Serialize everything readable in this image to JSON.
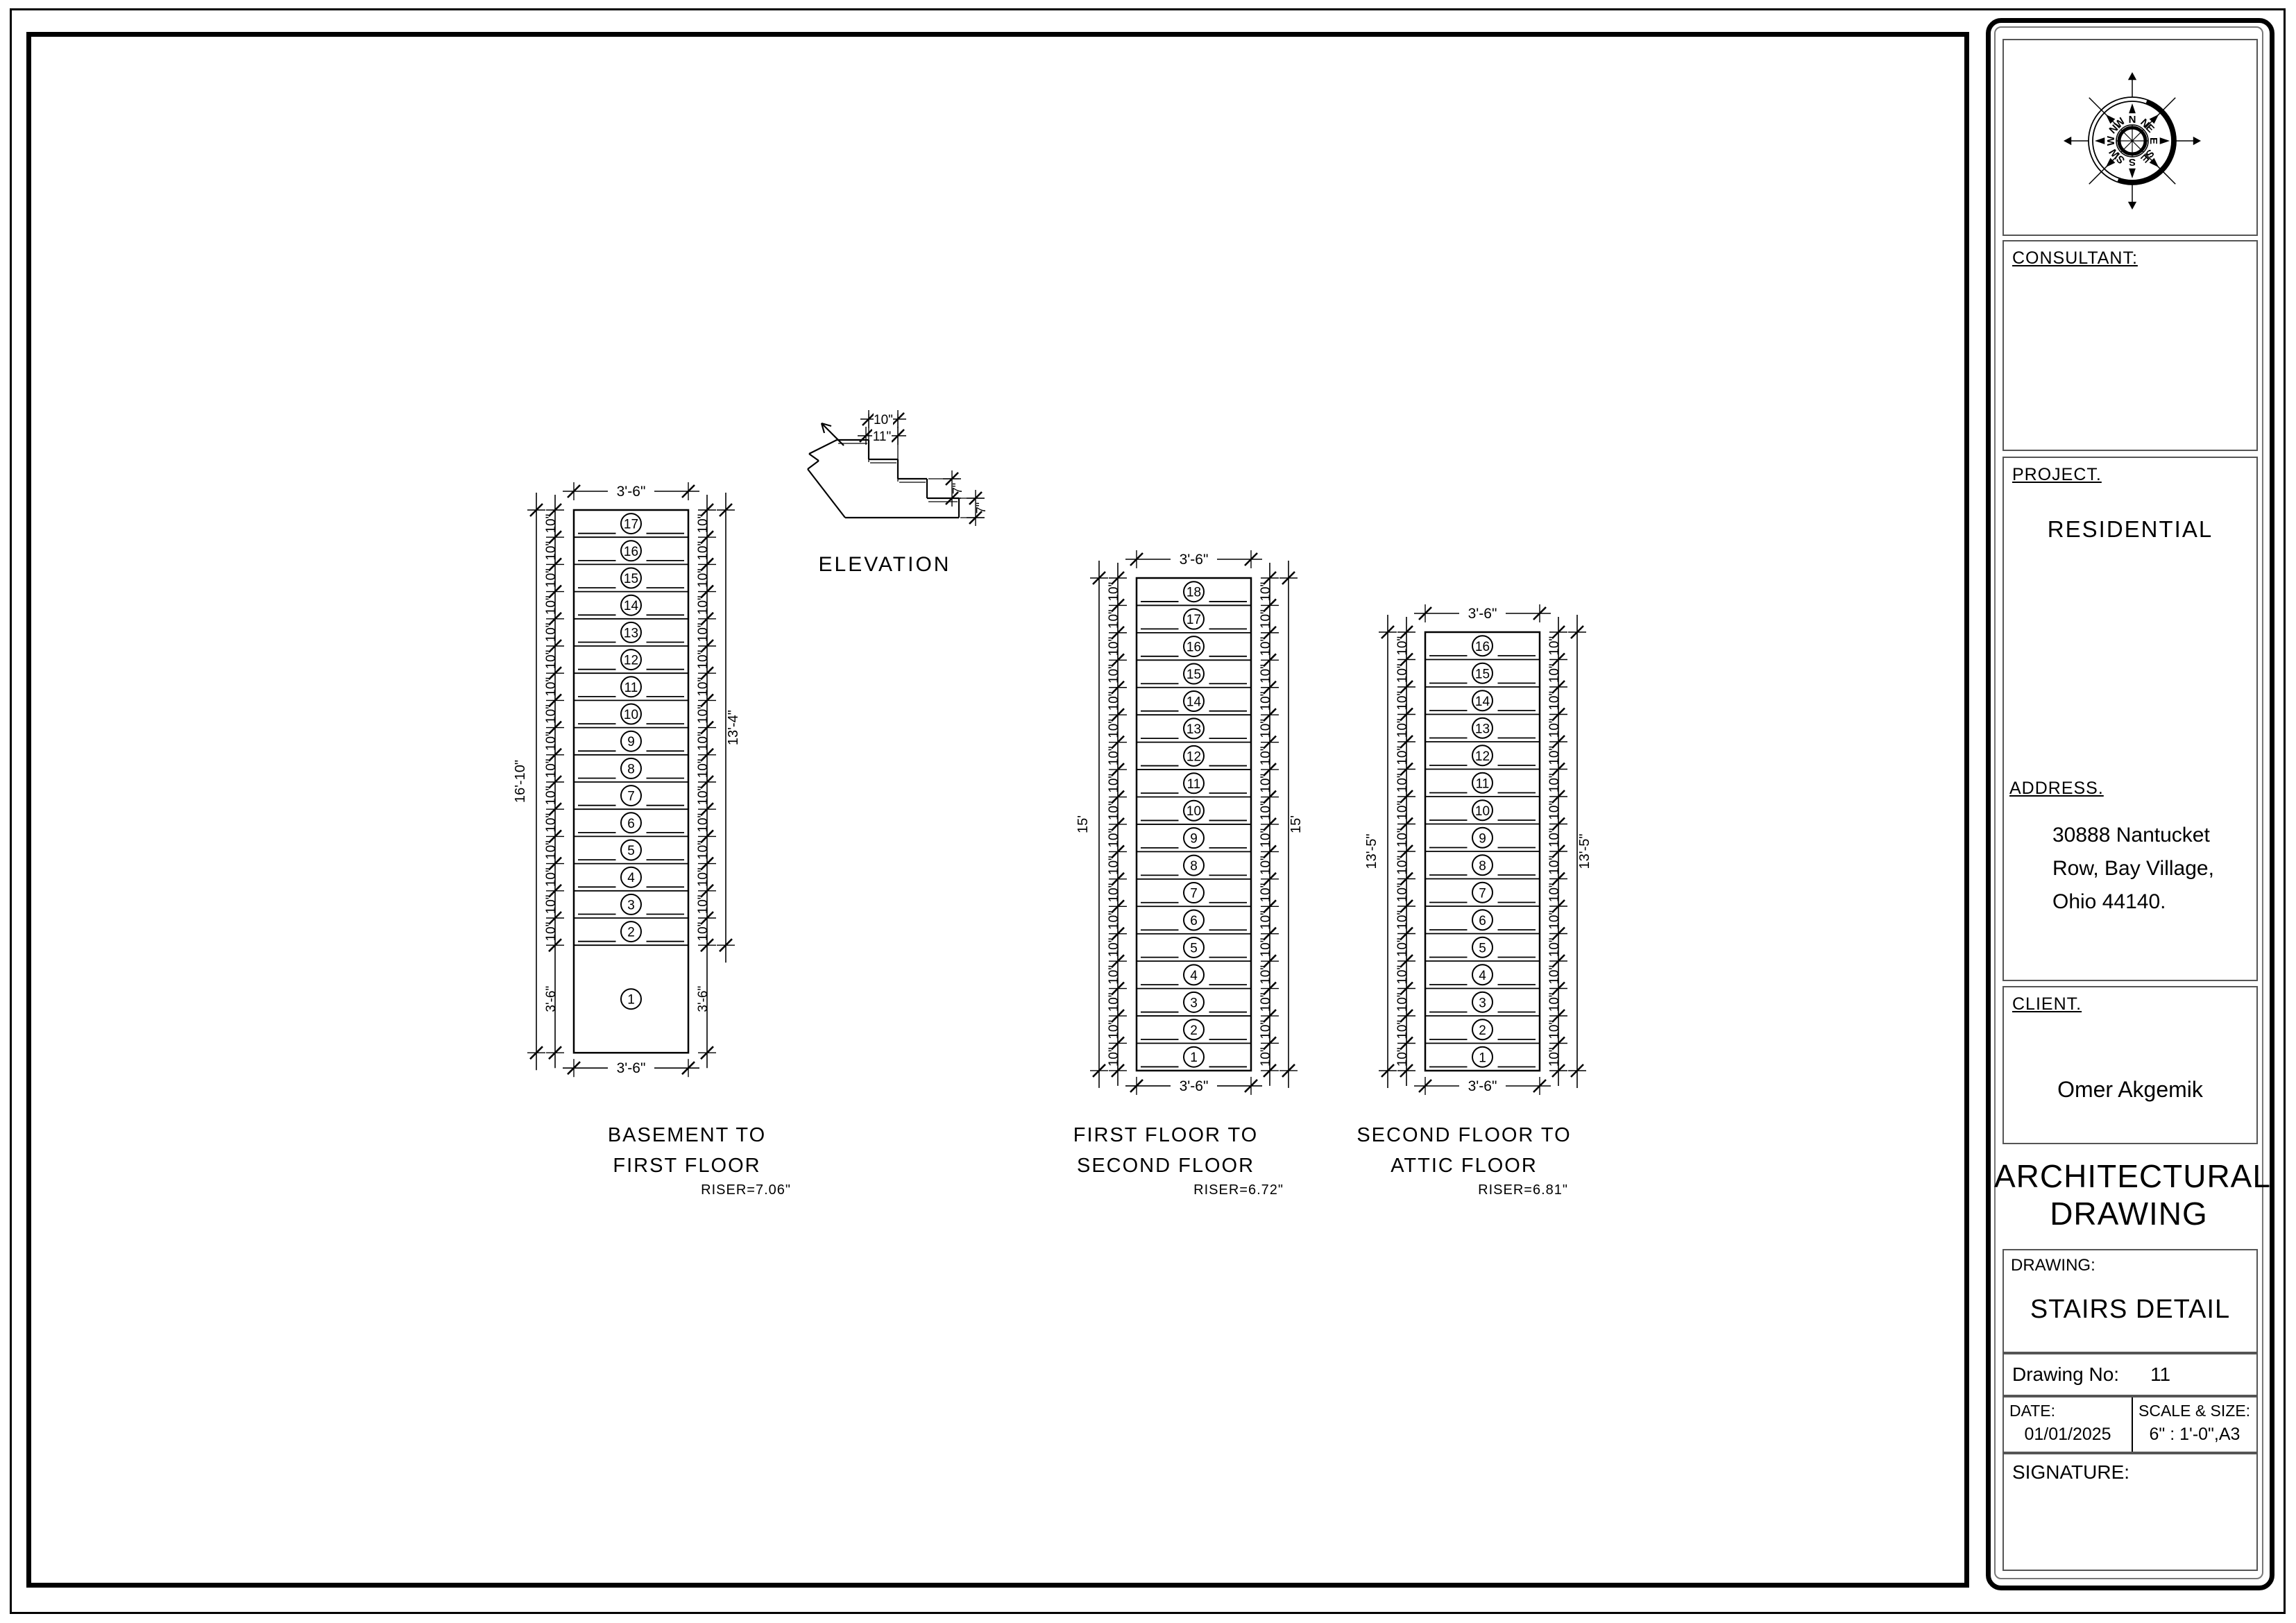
{
  "page": {
    "sheet_bg": "#ffffff",
    "line_color": "#000000"
  },
  "elevation": {
    "title": "ELEVATION",
    "tread_label": "10\"",
    "nosing_label": "11\"",
    "riser_labels": [
      "7\"",
      "7\""
    ]
  },
  "stairs": [
    {
      "title1": "BASEMENT TO",
      "title2": "FIRST FLOOR",
      "riser_note": "RISER=7.06\"",
      "tread_count": 16,
      "top_tread_number": 17,
      "landing_number": "1",
      "tread_depth_label": "10\"",
      "width_label": "3'-6\"",
      "landing_label": "3'-6\"",
      "left_total_label": "16'-10\"",
      "right_total_label": "13'-4\""
    },
    {
      "title1": "FIRST FLOOR TO",
      "title2": "SECOND FLOOR",
      "riser_note": "RISER=6.72\"",
      "tread_count": 18,
      "top_tread_number": 18,
      "tread_depth_label": "10\"",
      "width_label": "3'-6\"",
      "left_total_label": "15'",
      "right_total_label": "15'"
    },
    {
      "title1": "SECOND FLOOR TO",
      "title2": "ATTIC FLOOR",
      "riser_note": "RISER=6.81\"",
      "tread_count": 16,
      "top_tread_number": 16,
      "tread_depth_label": "10\"",
      "width_label": "3'-6\"",
      "left_total_label": "13'-5\"",
      "right_total_label": "13'-5\""
    }
  ],
  "title_block": {
    "consultant_label": "CONSULTANT:",
    "project_label": "PROJECT.",
    "project_value": "RESIDENTIAL",
    "address_label": "ADDRESS.",
    "address_lines": [
      "30888 Nantucket",
      "Row, Bay Village,",
      "Ohio 44140."
    ],
    "client_label": "CLIENT.",
    "client_value": "Omer Akgemik",
    "doc_title": "ARCHITECTURAL DRAWING",
    "drawing_label": "DRAWING:",
    "drawing_value": "STAIRS DETAIL",
    "drawing_no_label": "Drawing No:",
    "drawing_no_value": "11",
    "date_label": "DATE:",
    "date_value": "01/01/2025",
    "scale_label": "SCALE & SIZE:",
    "scale_value": "6\" : 1'-0\",A3",
    "signature_label": "SIGNATURE:",
    "compass": {
      "cardinals": [
        "N",
        "NE",
        "E",
        "SE",
        "S",
        "SW",
        "W",
        "NW"
      ]
    }
  }
}
